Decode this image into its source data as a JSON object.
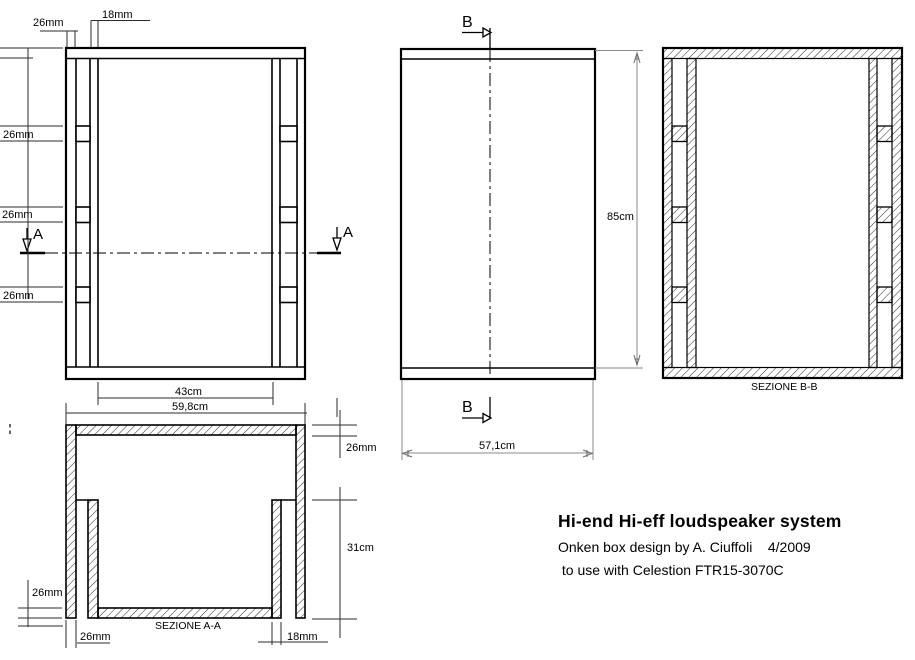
{
  "colors": {
    "ink": "#000000",
    "dim_line": "#2b2b2b",
    "dim_line_gray": "#8a8a8a",
    "background": "#ffffff"
  },
  "front_view": {
    "dim_top_wall": "26mm",
    "dim_top_slat": "18mm",
    "dim_slot_1": "26mm",
    "dim_slot_2": "26mm",
    "dim_slot_3": "26mm",
    "dim_inner_width": "43cm",
    "dim_outer_width": "59,8cm",
    "cut_label_left": "A",
    "cut_label_right": "A"
  },
  "side_view": {
    "cut_label_top": "B",
    "cut_label_bottom": "B",
    "dim_height": "85cm",
    "dim_depth": "57,1cm"
  },
  "section_bb": {
    "title": "SEZIONE B-B"
  },
  "section_aa": {
    "title": "SEZIONE A-A",
    "dim_back_panel": "26mm",
    "dim_duct_depth": "31cm",
    "dim_bottom_panel": "26mm",
    "dim_wall": "26mm",
    "dim_slat": "18mm"
  },
  "title_block": {
    "title": "Hi-end Hi-eff loudspeaker system",
    "line2": "Onken box design by A. Ciuffoli    4/2009",
    "line3": " to use with Celestion FTR15-3070C"
  }
}
